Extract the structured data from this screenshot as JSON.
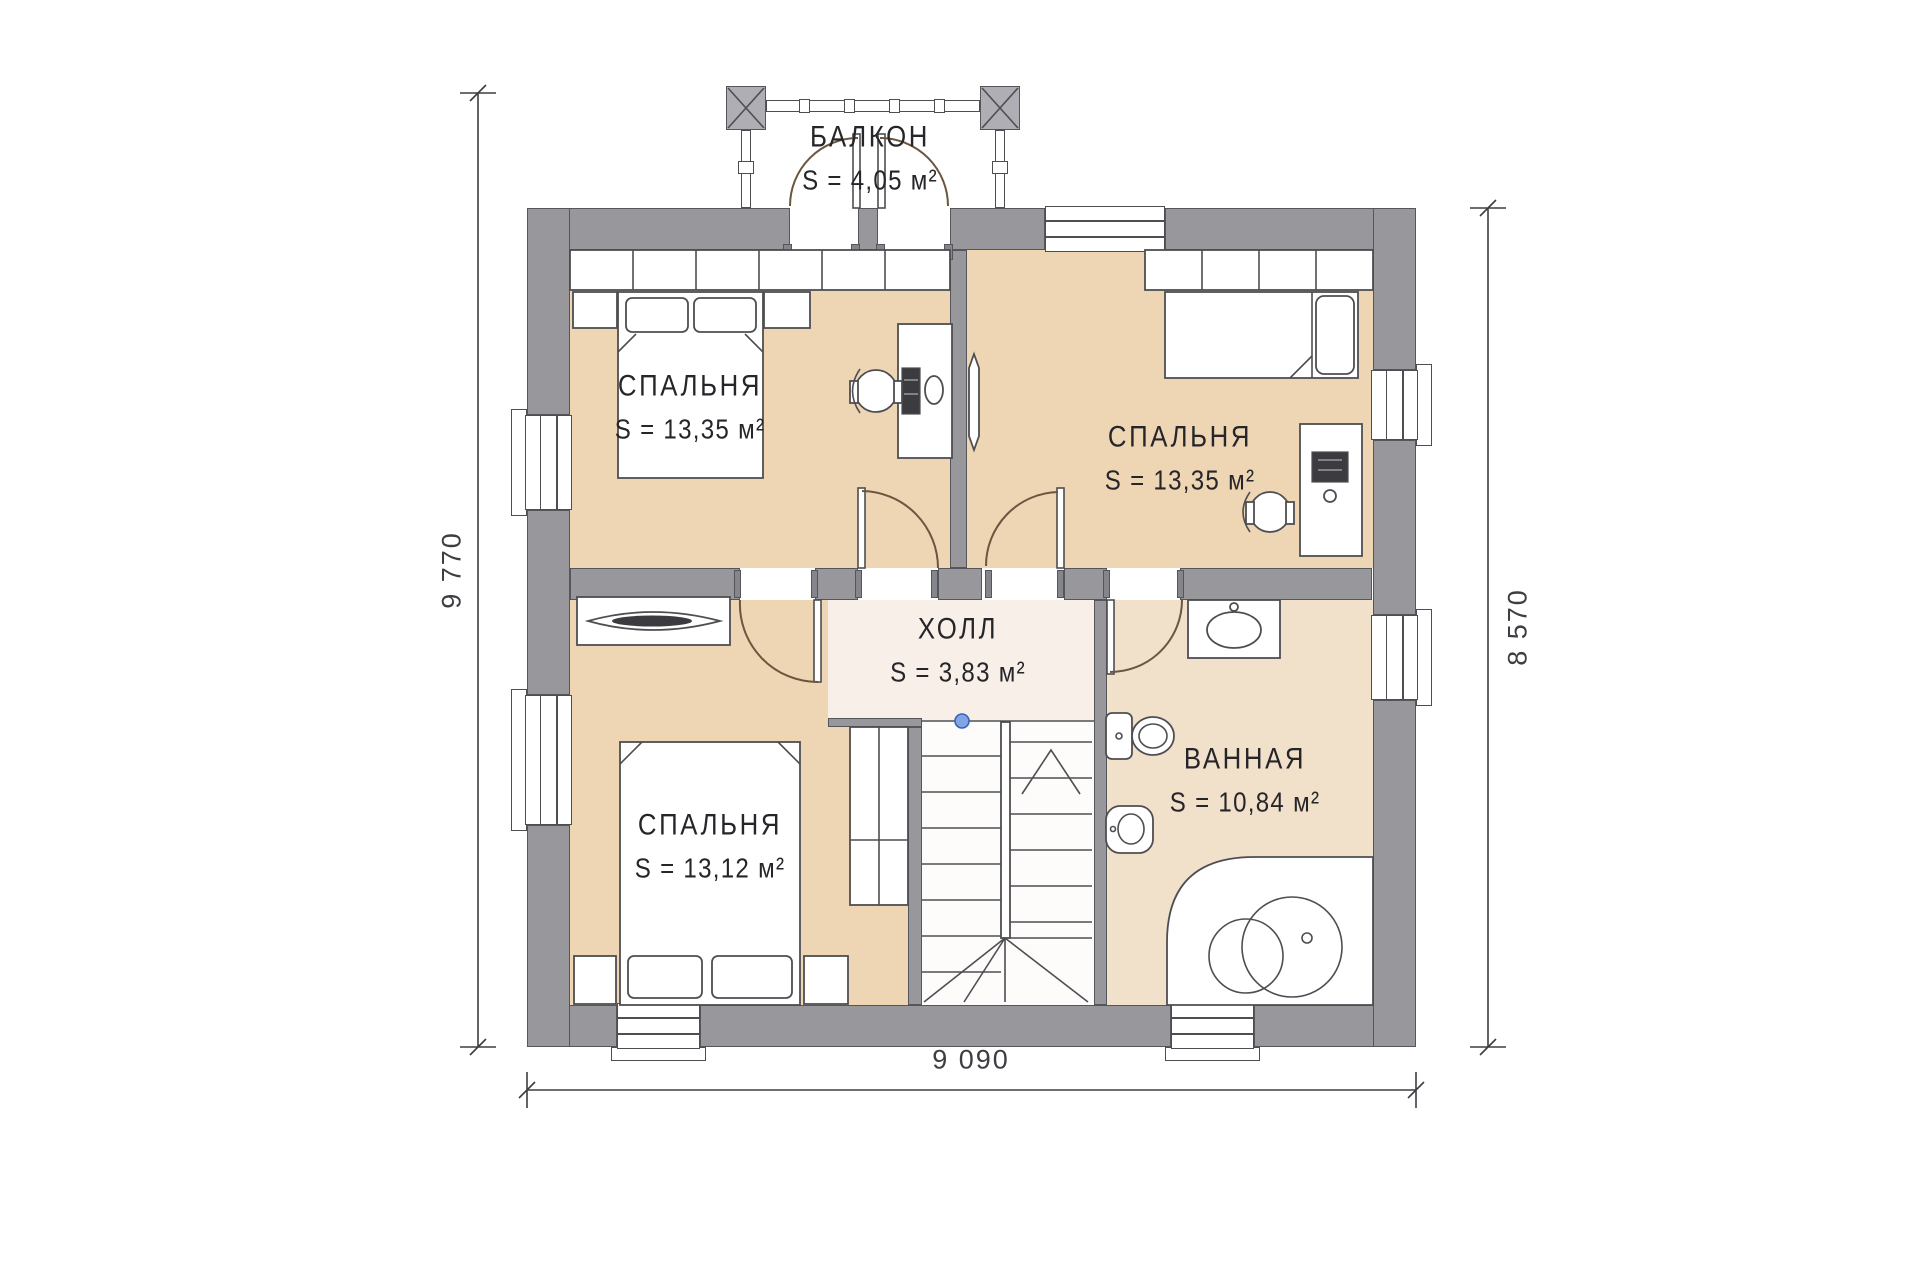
{
  "rooms": {
    "balcony": {
      "name": "БАЛКОН",
      "area": "S = 4,05 м²"
    },
    "bedroom_tl": {
      "name": "СПАЛЬНЯ",
      "area": "S = 13,35 м²"
    },
    "bedroom_tr": {
      "name": "СПАЛЬНЯ",
      "area": "S = 13,35 м²"
    },
    "hall": {
      "name": "ХОЛЛ",
      "area": "S = 3,83 м²"
    },
    "bedroom_bl": {
      "name": "СПАЛЬНЯ",
      "area": "S = 13,12 м²"
    },
    "bathroom": {
      "name": "ВАННАЯ",
      "area": "S = 10,84 м²"
    }
  },
  "dimensions": {
    "left_mm": "9 770",
    "right_mm": "8 570",
    "bottom_mm": "9 090"
  },
  "colors": {
    "wall": "#97979c",
    "wall-edge": "#55555c",
    "line": "#4e4e52",
    "door": "#6b5640",
    "floor-bedroom": "#eed5b4",
    "floor-hall": "#f8efe8",
    "floor-bath": "#f1e0ca",
    "floor-stairs": "#fdfcfa",
    "dim": "#3d3e42",
    "text": "#26262a",
    "newel": "#82a4e4",
    "dark-item": "#3c3c40"
  }
}
